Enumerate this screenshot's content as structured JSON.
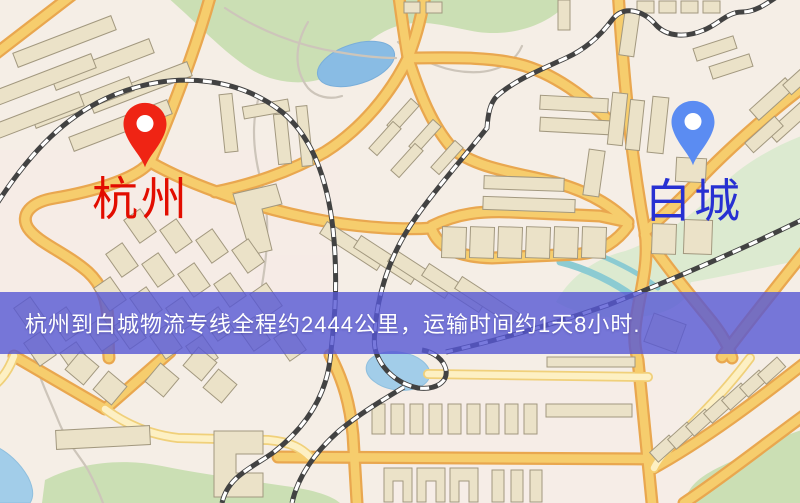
{
  "banner": {
    "text": "杭州到白城物流专线全程约2444公里，运输时间约1天8小时.",
    "background_color": "#5658d4",
    "text_color": "#ffffff"
  },
  "origin": {
    "name": "杭州",
    "pin_color": "#ef2414",
    "pin_inner_color": "#ffffff",
    "label_color": "#e20d00",
    "icon": "map-pin-icon"
  },
  "destination": {
    "name": "白城",
    "pin_color": "#5b8cf2",
    "pin_inner_color": "#ffffff",
    "label_color": "#2730d2",
    "icon": "map-pin-icon"
  },
  "route": {
    "distance_text": "约2444公里",
    "duration_text": "约1天8小时"
  },
  "map_colors": {
    "background": "#f5eee6",
    "road_fill": "#f6cd6d",
    "road_casing": "#e9a74f",
    "road_minor_fill": "#fdf0c3",
    "building_fill": "#ebe2c8",
    "building_stroke": "#a2987f",
    "park": "#cbdfb4",
    "park_pale": "#dcead0",
    "water": "#89bce4",
    "railway": "#424242"
  }
}
